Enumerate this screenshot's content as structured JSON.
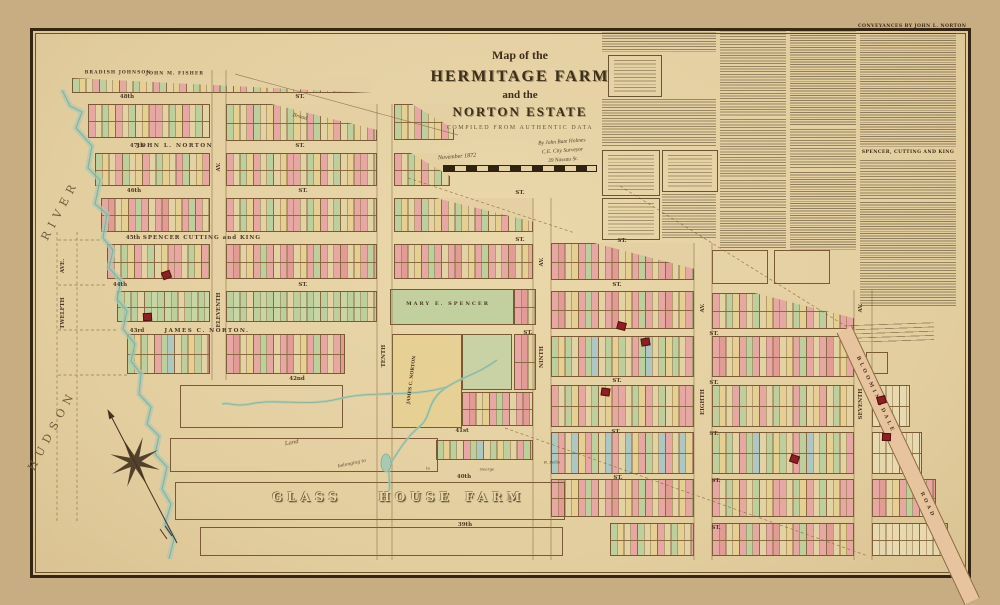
{
  "title": {
    "line1": "Map of the",
    "line2": "HERMITAGE FARM",
    "line3": "and the",
    "line4": "NORTON ESTATE",
    "line5": "COMPILED FROM AUTHENTIC DATA"
  },
  "signature": {
    "date": "November 1872",
    "line1": "By John Bute Holmes",
    "line2": "C.E. City Surveyor",
    "line3": "39 Nassau St."
  },
  "road": {
    "name_top": "BLOOMINGDALE",
    "name_bottom": "ROAD"
  },
  "panel": {
    "h1": "CONVEYANCES BY JOHN L. NORTON",
    "h2": "SPENCER, CUTTING AND KING",
    "items": [
      [
        "para",
        602,
        30,
        114,
        22
      ],
      [
        "box",
        608,
        55,
        52,
        40
      ],
      [
        "para",
        602,
        99,
        114,
        48
      ],
      [
        "box",
        602,
        150,
        56,
        44
      ],
      [
        "box",
        662,
        150,
        54,
        40
      ],
      [
        "box",
        602,
        198,
        56,
        40
      ],
      [
        "para",
        662,
        194,
        54,
        44
      ],
      [
        "para",
        720,
        28,
        66,
        88
      ],
      [
        "para",
        720,
        119,
        66,
        58
      ],
      [
        "para",
        720,
        180,
        66,
        28
      ],
      [
        "list",
        720,
        211,
        66,
        37
      ],
      [
        "list",
        790,
        28,
        66,
        98
      ],
      [
        "para",
        790,
        129,
        66,
        40
      ],
      [
        "list",
        790,
        172,
        66,
        78
      ],
      [
        "list",
        860,
        33,
        96,
        114
      ],
      [
        "para",
        860,
        160,
        96,
        40
      ],
      [
        "list",
        860,
        202,
        96,
        58
      ],
      [
        "para",
        860,
        262,
        96,
        46
      ]
    ]
  },
  "colors": {
    "paper": "#e4d0a3",
    "lot_line": "#8a6b42",
    "building": "#8c2023",
    "water_band": "#a9cab5",
    "water_edge": "#7fae94",
    "palettes": {
      "mixA": [
        "#e7a7a2",
        "#e3d2a4",
        "#bccf9d",
        "#e5cf92",
        "#e7a7a2",
        "#e3d2a4",
        "#bccf9d",
        "#e3d2a4",
        "#e5cf92",
        "#e7a7a2"
      ],
      "mixB": [
        "#bccf9d",
        "#e5cf92",
        "#e3d2a4",
        "#e7a7a2",
        "#bccf9d",
        "#e3d2a4",
        "#e5cf92",
        "#e7a7a2",
        "#e3d2a4"
      ],
      "mixP": [
        "#e7a7a2",
        "#e39b96",
        "#e3d2a4",
        "#e5cf92",
        "#e7a7a2",
        "#bccf9d",
        "#e7a7a2",
        "#e3d2a4"
      ],
      "greenH": [
        "#bccf9d",
        "#c8d6a6",
        "#bccf9d",
        "#e3d2a4",
        "#bccf9d",
        "#c8d6a6"
      ],
      "mixG": [
        "#bccf9d",
        "#e5cf92",
        "#bccf9d",
        "#e3d2a4",
        "#e7a7a2",
        "#bccf9d",
        "#adc8c3",
        "#e3d2a4"
      ],
      "mixBlue": [
        "#adc8c3",
        "#e7a7a2",
        "#e3d2a4",
        "#adc8c3",
        "#e5cf92",
        "#e7a7a2",
        "#bccf9d",
        "#e3d2a4"
      ],
      "pale": [
        "#e8dab0",
        "#e6d6ac",
        "#e8dab0",
        "#ead9ae"
      ]
    }
  },
  "map": {
    "blocks": [
      [
        72,
        78,
        300,
        15,
        "mixB",
        1,
        "full"
      ],
      [
        88,
        104,
        122,
        34,
        "mixA",
        2,
        null
      ],
      [
        226,
        104,
        151,
        37,
        "mixB",
        2,
        "ne"
      ],
      [
        394,
        104,
        60,
        36,
        "mixB",
        2,
        "ne"
      ],
      [
        95,
        153,
        115,
        33,
        "mixB",
        2,
        null
      ],
      [
        226,
        153,
        151,
        33,
        "mixA",
        2,
        null
      ],
      [
        394,
        153,
        56,
        33,
        "mixA",
        2,
        "ne"
      ],
      [
        101,
        198,
        109,
        34,
        "mixP",
        2,
        null
      ],
      [
        226,
        198,
        151,
        34,
        "mixA",
        2,
        null
      ],
      [
        394,
        198,
        139,
        34,
        "mixB",
        2,
        "ne"
      ],
      [
        107,
        244,
        103,
        35,
        "mixA",
        2,
        null
      ],
      [
        226,
        244,
        151,
        35,
        "mixP",
        2,
        null
      ],
      [
        394,
        244,
        139,
        35,
        "mixP",
        2,
        null
      ],
      [
        551,
        243,
        143,
        37,
        "mixP",
        2,
        "ne"
      ],
      [
        117,
        291,
        93,
        31,
        "greenH",
        2,
        null
      ],
      [
        226,
        291,
        151,
        31,
        "greenH",
        2,
        null
      ],
      [
        514,
        289,
        22,
        36,
        "mixP",
        2,
        null
      ],
      [
        551,
        291,
        143,
        38,
        "mixP",
        2,
        null
      ],
      [
        712,
        293,
        142,
        36,
        "mixA",
        2,
        "ne"
      ],
      [
        127,
        334,
        83,
        40,
        "mixG",
        2,
        null
      ],
      [
        226,
        334,
        119,
        40,
        "mixP",
        2,
        null
      ],
      [
        514,
        334,
        22,
        56,
        "mixP",
        2,
        null
      ],
      [
        551,
        336,
        143,
        41,
        "mixG",
        2,
        null
      ],
      [
        712,
        336,
        142,
        41,
        "mixP",
        2,
        null
      ],
      [
        462,
        392,
        71,
        34,
        "mixP",
        2,
        null
      ],
      [
        551,
        385,
        143,
        42,
        "mixA",
        2,
        null
      ],
      [
        712,
        385,
        142,
        42,
        "mixB",
        2,
        null
      ],
      [
        872,
        385,
        38,
        42,
        "pale",
        2,
        null
      ],
      [
        436,
        440,
        97,
        20,
        "mixG",
        1,
        null
      ],
      [
        551,
        432,
        143,
        42,
        "mixBlue",
        2,
        null
      ],
      [
        712,
        432,
        142,
        42,
        "mixG",
        2,
        null
      ],
      [
        872,
        432,
        50,
        42,
        "pale",
        2,
        null
      ],
      [
        551,
        479,
        143,
        38,
        "mixP",
        2,
        null
      ],
      [
        712,
        479,
        142,
        38,
        "mixA",
        2,
        null
      ],
      [
        872,
        479,
        64,
        38,
        "mixP",
        2,
        null
      ],
      [
        610,
        523,
        84,
        33,
        "mixB",
        2,
        null
      ],
      [
        712,
        523,
        142,
        33,
        "mixP",
        2,
        null
      ],
      [
        872,
        523,
        76,
        33,
        "pale",
        2,
        null
      ],
      [
        712,
        250,
        56,
        34,
        "none",
        1,
        null
      ],
      [
        774,
        250,
        56,
        34,
        "none",
        1,
        null
      ],
      [
        866,
        352,
        22,
        22,
        "none",
        1,
        null
      ],
      [
        170,
        438,
        268,
        34,
        "none",
        1,
        null
      ],
      [
        175,
        482,
        390,
        38,
        "none",
        1,
        null
      ],
      [
        200,
        527,
        363,
        29,
        "none",
        1,
        null
      ],
      [
        180,
        385,
        163,
        43,
        "none",
        1,
        null
      ]
    ],
    "flats": [
      [
        390,
        289,
        124,
        36,
        "#c2cf9f"
      ],
      [
        392,
        334,
        70,
        94,
        "#e6d093"
      ],
      [
        462,
        334,
        50,
        56,
        "#c9d2a4"
      ]
    ],
    "buildings": [
      [
        162,
        271
      ],
      [
        143,
        313
      ],
      [
        617,
        322
      ],
      [
        641,
        338
      ],
      [
        601,
        388
      ],
      [
        877,
        396
      ],
      [
        882,
        433
      ],
      [
        790,
        455
      ]
    ],
    "labels": [
      {
        "t": "48th",
        "x": 127,
        "y": 97,
        "k": "street"
      },
      {
        "t": "ST.",
        "x": 300,
        "y": 97,
        "k": "street"
      },
      {
        "t": "47th",
        "x": 137,
        "y": 146,
        "k": "street"
      },
      {
        "t": "JOHN L. NORTON",
        "x": 175,
        "y": 146,
        "sp": 1.5,
        "k": "farm"
      },
      {
        "t": "ST.",
        "x": 300,
        "y": 146,
        "k": "street"
      },
      {
        "t": "46th",
        "x": 134,
        "y": 191,
        "k": "street"
      },
      {
        "t": "ST.",
        "x": 303,
        "y": 191,
        "k": "street"
      },
      {
        "t": "ST.",
        "x": 520,
        "y": 193,
        "k": "street"
      },
      {
        "t": "45th",
        "x": 133,
        "y": 238,
        "k": "street"
      },
      {
        "t": "SPENCER CUTTING and KING",
        "x": 202,
        "y": 238,
        "sp": 1,
        "k": "farm"
      },
      {
        "t": "ST.",
        "x": 520,
        "y": 240,
        "k": "street"
      },
      {
        "t": "ST.",
        "x": 622,
        "y": 241,
        "k": "street"
      },
      {
        "t": "44th",
        "x": 120,
        "y": 285,
        "k": "street"
      },
      {
        "t": "ST.",
        "x": 303,
        "y": 285,
        "k": "street"
      },
      {
        "t": "ST.",
        "x": 617,
        "y": 285,
        "k": "street"
      },
      {
        "t": "43rd",
        "x": 137,
        "y": 331,
        "k": "street"
      },
      {
        "t": "JAMES C. NORTON.",
        "x": 207,
        "y": 331,
        "sp": 1.5,
        "k": "farm"
      },
      {
        "t": "ST.",
        "x": 528,
        "y": 333,
        "k": "street"
      },
      {
        "t": "ST.",
        "x": 714,
        "y": 334,
        "k": "street"
      },
      {
        "t": "42nd",
        "x": 297,
        "y": 379,
        "k": "street"
      },
      {
        "t": "ST.",
        "x": 617,
        "y": 381,
        "k": "street"
      },
      {
        "t": "ST.",
        "x": 714,
        "y": 383,
        "k": "street"
      },
      {
        "t": "41st",
        "x": 462,
        "y": 431,
        "k": "street"
      },
      {
        "t": "ST.",
        "x": 616,
        "y": 432,
        "k": "street"
      },
      {
        "t": "ST.",
        "x": 714,
        "y": 434,
        "k": "street"
      },
      {
        "t": "40th",
        "x": 464,
        "y": 477,
        "k": "street"
      },
      {
        "t": "ST.",
        "x": 618,
        "y": 478,
        "k": "street"
      },
      {
        "t": "ST.",
        "x": 716,
        "y": 481,
        "k": "street"
      },
      {
        "t": "39th",
        "x": 465,
        "y": 525,
        "k": "street"
      },
      {
        "t": "ST.",
        "x": 716,
        "y": 528,
        "k": "street"
      },
      {
        "t": "TWELFTH",
        "x": 63,
        "y": 313,
        "rot": -90,
        "k": "avenue"
      },
      {
        "t": "AVE.",
        "x": 63,
        "y": 266,
        "rot": -90,
        "k": "avenue"
      },
      {
        "t": "ELEVENTH",
        "x": 219,
        "y": 310,
        "rot": -90,
        "k": "avenue"
      },
      {
        "t": "AV.",
        "x": 219,
        "y": 167,
        "rot": -90,
        "k": "avenue"
      },
      {
        "t": "TENTH",
        "x": 384,
        "y": 356,
        "rot": -90,
        "k": "avenue"
      },
      {
        "t": "NINTH",
        "x": 542,
        "y": 357,
        "rot": -90,
        "k": "avenue"
      },
      {
        "t": "AV.",
        "x": 542,
        "y": 262,
        "rot": -90,
        "k": "avenue"
      },
      {
        "t": "EIGHTH",
        "x": 703,
        "y": 402,
        "rot": -90,
        "k": "avenue"
      },
      {
        "t": "AV.",
        "x": 703,
        "y": 308,
        "rot": -90,
        "k": "avenue"
      },
      {
        "t": "SEVENTH",
        "x": 861,
        "y": 404,
        "rot": -90,
        "k": "avenue"
      },
      {
        "t": "AV.",
        "x": 861,
        "y": 308,
        "rot": -90,
        "k": "avenue"
      },
      {
        "t": "HUDSON",
        "x": 52,
        "y": 430,
        "rot": -62,
        "s": 11,
        "sp": 6,
        "k": "water"
      },
      {
        "t": "RIVER",
        "x": 60,
        "y": 210,
        "rot": -62,
        "s": 11,
        "sp": 6,
        "k": "water"
      },
      {
        "t": "BRADISH JOHNSON",
        "x": 118,
        "y": 73,
        "s": 4.5,
        "sp": 1,
        "k": "farm"
      },
      {
        "t": "JOHN M. FISHER",
        "x": 175,
        "y": 74,
        "s": 4.5,
        "sp": 1,
        "k": "farm"
      },
      {
        "t": "MARY E. SPENCER",
        "x": 448,
        "y": 304,
        "s": 5,
        "sp": 2,
        "k": "farm"
      },
      {
        "t": "JAMES C. NORTON",
        "x": 412,
        "y": 380,
        "rot": -83,
        "s": 4.5,
        "k": "farm"
      },
      {
        "t": "Broad",
        "x": 300,
        "y": 117,
        "rot": 15,
        "hand": 1,
        "s": 5,
        "k": "annotation"
      },
      {
        "t": "Land",
        "x": 292,
        "y": 443,
        "rot": -10,
        "hand": 1,
        "s": 5.5,
        "k": "annotation"
      },
      {
        "t": "belonging to",
        "x": 352,
        "y": 464,
        "rot": -12,
        "hand": 1,
        "s": 4.5,
        "k": "annotation"
      },
      {
        "t": "to",
        "x": 428,
        "y": 468,
        "hand": 1,
        "s": 4,
        "k": "annotation"
      },
      {
        "t": "George",
        "x": 487,
        "y": 469,
        "hand": 1,
        "s": 4,
        "k": "annotation"
      },
      {
        "t": "R. Pellis",
        "x": 552,
        "y": 462,
        "hand": 1,
        "s": 4,
        "k": "annotation"
      }
    ],
    "glass_farm": {
      "words": [
        "GLASS",
        "HOUSE",
        "FARM"
      ],
      "xs": [
        307,
        416,
        495
      ],
      "y": 497
    },
    "shore": "M62,90 L70,106 82,112 76,128 92,146 88,168 100,180 95,204 107,214 103,238 113,250 109,268 121,281 117,299 127,311 123,329 135,344 131,361 141,374 139,394 151,407 147,424 159,436 155,454 167,467 162,489 171,504 165,524 174,539 169,559",
    "streams": [
      "M497,360 C478,374 462,377 447,387 C425,401 433,416 419,427 C407,437 399,450 392,461 C386,471 391,479 389,491",
      "M447,387 C410,398 372,390 338,399 C306,407 276,398 250,404 C236,407 228,402 222,404"
    ],
    "pond": [
      386,
      463,
      5,
      9
    ],
    "solid_lines": [
      "M235,74 L458,135",
      "M377,104 L377,560",
      "M392,104 L392,560",
      "M533,198 L533,560",
      "M551,198 L551,560",
      "M694,243 L694,560",
      "M712,243 L712,560",
      "M854,290 L854,560",
      "M872,290 L872,560",
      "M212,70 L212,380",
      "M226,70 L226,380"
    ],
    "dashed_lines": [
      "M620,186 L852,330",
      "M505,428 L868,556",
      "M408,178 L575,233",
      "M57,232 L57,522",
      "M77,232 L77,522",
      "M58,375 L127,375",
      "M58,330 L117,330",
      "M58,285 L107,285",
      "M58,240 L101,240"
    ],
    "compass": {
      "cx": 135,
      "cy": 462,
      "r_out": 26,
      "r_in": 6.5,
      "angle": -117.5,
      "needle": [
        177,
        543,
        112,
        418
      ]
    }
  }
}
